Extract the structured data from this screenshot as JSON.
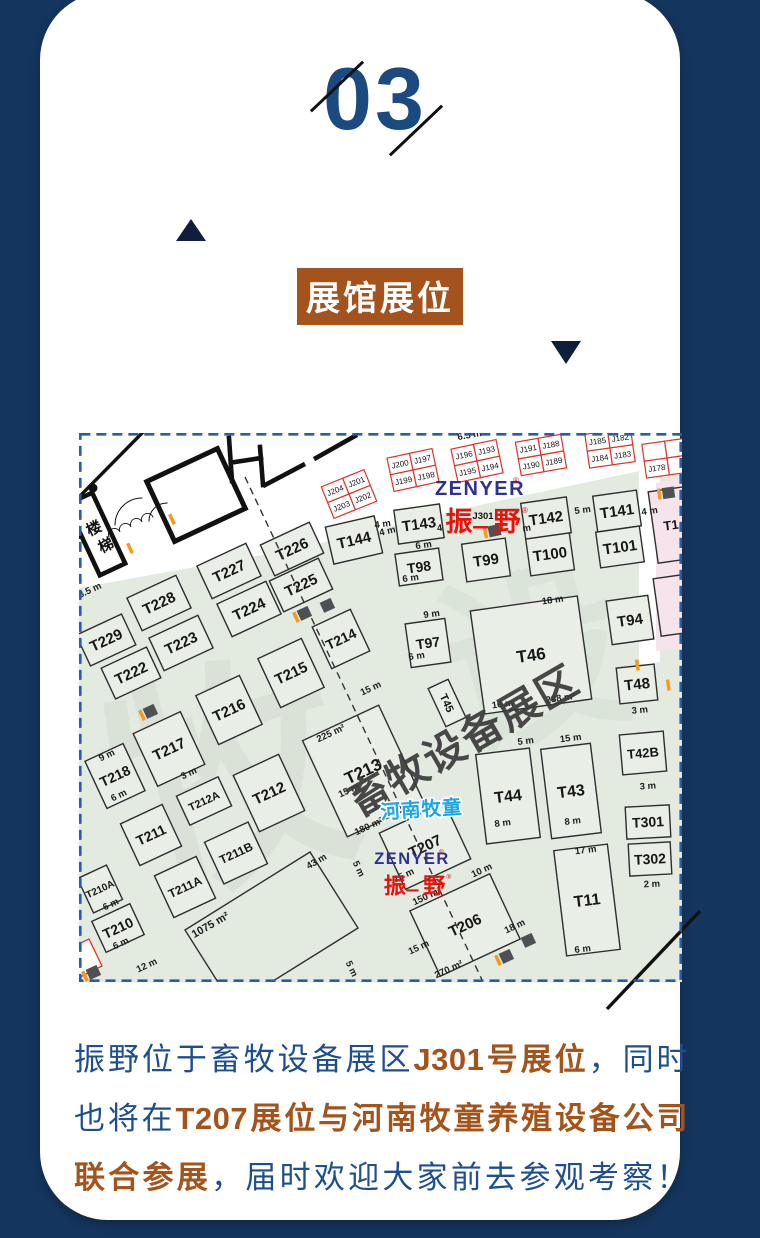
{
  "page": {
    "background": "#14355e",
    "card_background": "#ffffff"
  },
  "header": {
    "section_number": "03",
    "title": "展馆展位",
    "number_color": "#1b4a80",
    "title_bg": "#a5531d"
  },
  "map": {
    "colors": {
      "border": "#1e5fae",
      "floor": "#e3ebe1",
      "booth": "#e9efe6",
      "pink": "#f6e3eb",
      "red": "#e23127",
      "orange": "#f59a1e",
      "marker": "#4d5154",
      "stroke": "#2e2e2e"
    },
    "floor": [
      [
        0,
        155
      ],
      [
        221,
        115
      ],
      [
        401,
        72
      ],
      [
        603,
        29
      ],
      [
        603,
        549
      ],
      [
        0,
        549
      ]
    ],
    "corridor": [
      [
        560,
        36
      ],
      [
        581,
        33
      ],
      [
        581,
        229
      ],
      [
        560,
        232
      ]
    ],
    "pink_strip": [
      [
        577,
        50
      ],
      [
        603,
        46
      ],
      [
        603,
        214
      ],
      [
        577,
        218
      ]
    ],
    "area1075": [
      [
        106,
        497
      ],
      [
        231,
        419
      ],
      [
        279,
        495
      ],
      [
        154,
        573
      ]
    ],
    "red_partial": [
      [
        -17,
        519
      ],
      [
        10,
        506
      ],
      [
        23,
        533
      ],
      [
        -3,
        546
      ]
    ],
    "aisle": [
      166,
      44,
      404,
      549
    ],
    "booths": [
      [
        "T226",
        213,
        116,
        54,
        34,
        -25,
        15
      ],
      [
        "T225",
        222,
        152,
        54,
        34,
        -25,
        15
      ],
      [
        "T227",
        150,
        138,
        54,
        36,
        -25,
        15
      ],
      [
        "T224",
        170,
        176,
        54,
        36,
        -25,
        15
      ],
      [
        "T228",
        80,
        170,
        54,
        36,
        -25,
        15
      ],
      [
        "T223",
        102,
        210,
        54,
        36,
        -25,
        15
      ],
      [
        "T229",
        27,
        207,
        50,
        34,
        -25,
        15
      ],
      [
        "T222",
        52,
        240,
        50,
        34,
        -25,
        15
      ],
      [
        "T214",
        262,
        206,
        42,
        46,
        -25,
        14
      ],
      [
        "T215",
        212,
        240,
        48,
        54,
        -25,
        15
      ],
      [
        "T216",
        150,
        277,
        48,
        54,
        -25,
        15
      ],
      [
        "T217",
        90,
        316,
        52,
        58,
        -25,
        15
      ],
      [
        "T218",
        36,
        343,
        42,
        52,
        -25,
        14
      ],
      [
        "T213",
        284,
        338,
        84,
        106,
        -25,
        17
      ],
      [
        "T212",
        190,
        360,
        50,
        62,
        -25,
        15
      ],
      [
        "T212A",
        125,
        368,
        46,
        32,
        -25,
        11
      ],
      [
        "T211",
        72,
        402,
        46,
        46,
        -25,
        14
      ],
      [
        "T211B",
        157,
        420,
        48,
        46,
        -25,
        12
      ],
      [
        "T211A",
        106,
        454,
        46,
        46,
        -25,
        12
      ],
      [
        "T210A",
        21,
        456,
        32,
        38,
        -25,
        10
      ],
      [
        "T210",
        39,
        495,
        42,
        34,
        -25,
        14
      ],
      [
        "T207",
        346,
        413,
        72,
        62,
        -25,
        15
      ],
      [
        "T206",
        386,
        492,
        88,
        72,
        -25,
        15
      ],
      [
        "T45",
        368,
        270,
        22,
        42,
        -25,
        11,
        "v"
      ],
      [
        "T144",
        275,
        107,
        50,
        38,
        -13,
        15
      ],
      [
        "T143",
        340,
        91,
        46,
        34,
        -8,
        15
      ],
      [
        "T98",
        340,
        134,
        44,
        32,
        -8,
        14
      ],
      [
        "T99",
        407,
        127,
        44,
        38,
        -8,
        15
      ],
      [
        "T100",
        471,
        121,
        44,
        38,
        -8,
        15
      ],
      [
        "T142",
        467,
        85,
        46,
        36,
        -8,
        15
      ],
      [
        "T141",
        538,
        78,
        44,
        36,
        -8,
        15
      ],
      [
        "T101",
        541,
        114,
        44,
        36,
        -8,
        15
      ],
      [
        "T97",
        349,
        210,
        40,
        44,
        -8,
        14
      ],
      [
        "T46",
        452,
        222,
        108,
        104,
        -8,
        17
      ],
      [
        "T94",
        551,
        187,
        42,
        44,
        -8,
        15
      ],
      [
        "T48",
        558,
        251,
        38,
        36,
        -6,
        15
      ],
      [
        "T42B",
        564,
        320,
        44,
        40,
        -5,
        13
      ],
      [
        "T44",
        429,
        363,
        54,
        90,
        -7,
        16
      ],
      [
        "T43",
        492,
        358,
        50,
        90,
        -7,
        16
      ],
      [
        "T301",
        569,
        389,
        44,
        32,
        -3,
        14
      ],
      [
        "T302",
        571,
        426,
        42,
        32,
        -3,
        14
      ],
      [
        "T11",
        508,
        467,
        54,
        106,
        -7,
        16
      ],
      [
        "T1",
        592,
        92,
        36,
        72,
        -8,
        13,
        "p"
      ],
      [
        "",
        596,
        172,
        36,
        58,
        -8,
        0,
        "p"
      ]
    ],
    "jgroups": [
      {
        "x": 270,
        "y": 61,
        "rot": -22,
        "cells": [
          [
            "J204",
            "J201"
          ],
          [
            "J203",
            "J202"
          ]
        ]
      },
      {
        "x": 334,
        "y": 37,
        "rot": -12,
        "cells": [
          [
            "J200",
            "J197"
          ],
          [
            "J199",
            "J198"
          ]
        ]
      },
      {
        "x": 398,
        "y": 28,
        "rot": -12,
        "cells": [
          [
            "J196",
            "J193"
          ],
          [
            "J195",
            "J194"
          ]
        ]
      },
      {
        "x": 462,
        "y": 22,
        "rot": -10,
        "cells": [
          [
            "J191",
            "J188"
          ],
          [
            "J190",
            "J189"
          ]
        ]
      },
      {
        "x": 531,
        "y": 15,
        "rot": -8,
        "cells": [
          [
            "J185",
            "J182"
          ],
          [
            "J184",
            "J183"
          ]
        ]
      },
      {
        "x": 588,
        "y": 25,
        "rot": -8,
        "cells": [
          [
            "",
            ""
          ],
          [
            "J178",
            ""
          ]
        ]
      }
    ],
    "dims": [
      [
        "4 m",
        304,
        94,
        -8
      ],
      [
        "6 m",
        345,
        115,
        -8
      ],
      [
        "6 m",
        332,
        148,
        -8
      ],
      [
        "4 m",
        309,
        101,
        -13
      ],
      [
        "5 m",
        504,
        80,
        -8
      ],
      [
        "4 m",
        571,
        81,
        -8
      ],
      [
        "9 m",
        353,
        184,
        -8
      ],
      [
        "6 m",
        338,
        226,
        -8
      ],
      [
        "18 m",
        474,
        170,
        -8
      ],
      [
        "16 m",
        424,
        274,
        -8
      ],
      [
        "288 m²",
        482,
        268,
        -8
      ],
      [
        "3 m",
        561,
        280,
        -5
      ],
      [
        "3 m",
        569,
        356,
        -4
      ],
      [
        "5 m",
        447,
        311,
        -7
      ],
      [
        "15 m",
        492,
        308,
        -7
      ],
      [
        "8 m",
        424,
        393,
        -7
      ],
      [
        "8 m",
        494,
        391,
        -7
      ],
      [
        "2 m",
        573,
        454,
        -3
      ],
      [
        "17 m",
        507,
        420,
        -7
      ],
      [
        "6 m",
        504,
        519,
        -7
      ],
      [
        "9 m",
        29,
        325,
        -25
      ],
      [
        "6 m",
        41,
        365,
        -25
      ],
      [
        "6 m",
        33,
        474,
        -25
      ],
      [
        "6 m",
        43,
        513,
        -25
      ],
      [
        "3 m",
        111,
        343,
        -25
      ],
      [
        "15 m",
        293,
        258,
        -25
      ],
      [
        "225 m²",
        253,
        303,
        -25
      ],
      [
        "15 m",
        271,
        360,
        -25
      ],
      [
        "150 m²",
        349,
        466,
        -25
      ],
      [
        "15 m",
        341,
        517,
        -25
      ],
      [
        "270 m²",
        371,
        539,
        -25
      ],
      [
        "10 m",
        404,
        440,
        -25
      ],
      [
        "18 m",
        437,
        496,
        -25
      ],
      [
        "180 m²",
        291,
        396,
        -25
      ],
      [
        "15 m",
        326,
        445,
        -25
      ],
      [
        "1075 m²",
        133,
        495,
        -30,
        11
      ],
      [
        "43 m",
        239,
        431,
        -30
      ],
      [
        "5 m",
        277,
        437,
        65
      ],
      [
        "5 m",
        270,
        537,
        65
      ],
      [
        "12 m",
        69,
        535,
        -25
      ],
      [
        "8.5 m",
        12,
        160,
        -25
      ],
      [
        "6.5 m",
        391,
        5,
        -10
      ],
      [
        "4",
        361,
        98,
        -8
      ],
      [
        "m",
        448,
        98,
        -8
      ]
    ],
    "markers": [
      [
        414,
        98,
        -12,
        "ts"
      ],
      [
        224,
        181,
        -25,
        "ts"
      ],
      [
        247,
        173,
        -25,
        "s"
      ],
      [
        70,
        279,
        -25,
        "ts"
      ],
      [
        588,
        60,
        -8,
        "ts"
      ],
      [
        448,
        508,
        -25,
        "s"
      ],
      [
        426,
        524,
        -25,
        "ts"
      ],
      [
        13,
        540,
        -25,
        "ts"
      ],
      [
        100,
        83,
        -25,
        "t"
      ],
      [
        58,
        112,
        -25,
        "t"
      ],
      [
        566,
        231,
        -8,
        "t"
      ],
      [
        597,
        251,
        -8,
        "t"
      ]
    ],
    "stairs": {
      "rot": -25,
      "chars": [
        {
          "t": "楼",
          "x": 17,
          "y": 100
        },
        {
          "t": "梯",
          "x": 29,
          "y": 117
        },
        {
          "t": "梯",
          "x": -4,
          "y": 108
        }
      ]
    },
    "logos": {
      "zenyer_text": "ZENYER",
      "brand_char1": "振",
      "brand_char2": "野",
      "reg_mark": "®",
      "booth_code": "J301",
      "zenyer_color": "#2e3192",
      "brand_color": "#e8120c",
      "top": {
        "x": 401,
        "y": 62
      },
      "bottom": {
        "x": 333,
        "y": 431
      },
      "henan": {
        "text": "河南牧童",
        "x": 343,
        "y": 383,
        "color": "#1aa7e3"
      }
    },
    "watermarks": {
      "main": {
        "text": "畜牧设备展区",
        "x": 392,
        "y": 320,
        "rot": -30,
        "size": 41,
        "color": "#3b3b3b",
        "opacity": 0.93
      },
      "faint": [
        {
          "text": "牧",
          "x": 170,
          "y": 430,
          "size": 240,
          "opacity": 0.07
        },
        {
          "text": "设",
          "x": 470,
          "y": 290,
          "size": 190,
          "opacity": 0.06
        }
      ]
    }
  },
  "footer": {
    "lines": [
      [
        {
          "t": "振野位于畜牧设备展区",
          "c": "b"
        },
        {
          "t": "J301号展位",
          "c": "o"
        },
        {
          "t": "，同时",
          "c": "b"
        }
      ],
      [
        {
          "t": "也将在",
          "c": "b"
        },
        {
          "t": "T207展位与河南牧童养殖设备公司",
          "c": "o"
        }
      ],
      [
        {
          "t": "联合参展",
          "c": "o"
        },
        {
          "t": "，届时欢迎大家前去参观考察！",
          "c": "b"
        }
      ]
    ],
    "blue": "#1d4e90",
    "brown": "#a4531a"
  }
}
